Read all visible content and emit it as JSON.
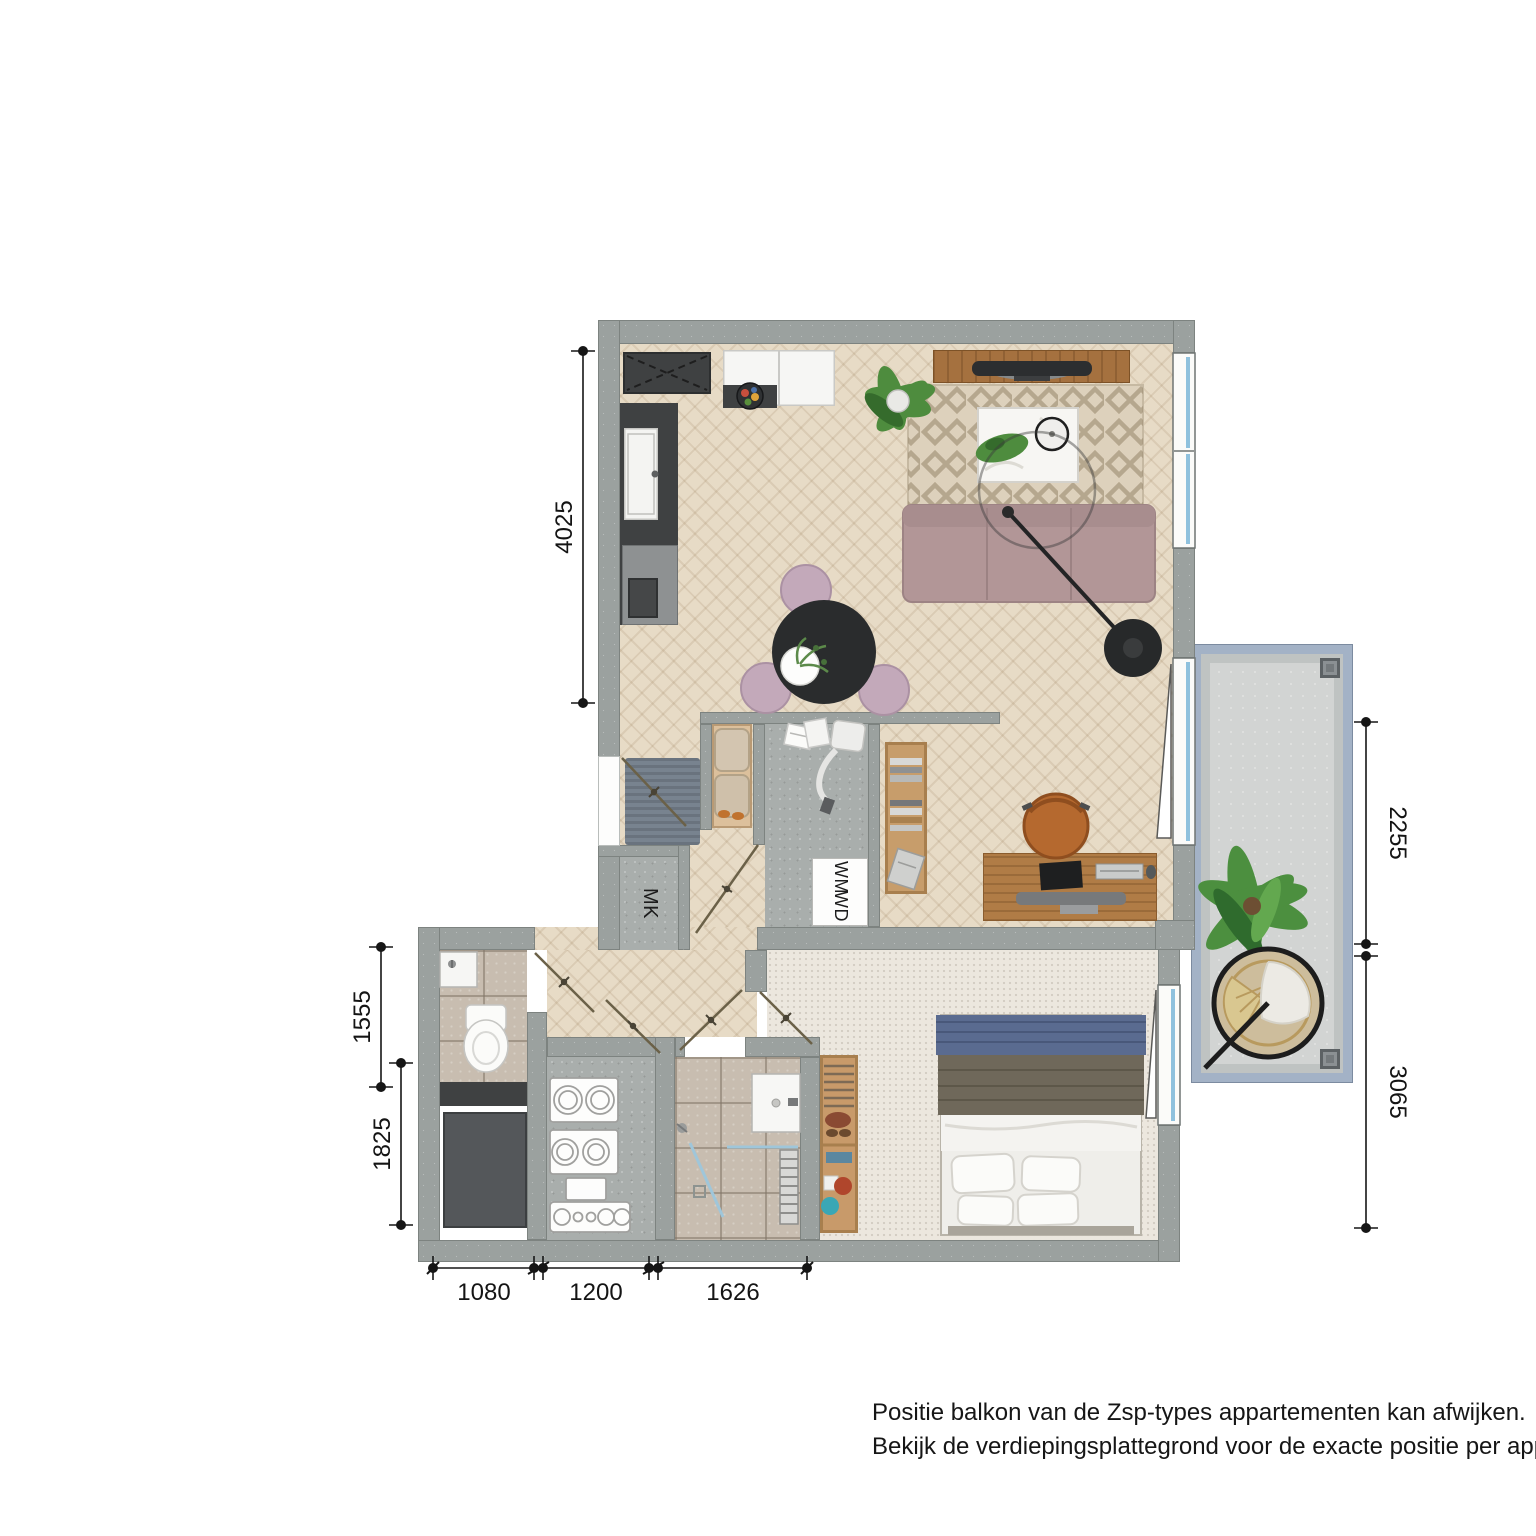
{
  "plan_title": "apartment-floor-plan",
  "labels": {
    "meter_cupboard": "MK",
    "washer": "WM",
    "dryer": "WD"
  },
  "dimensions": {
    "living_left_wall": "4025",
    "toilet_depth_left": "1555",
    "storage_depth_left": "1825",
    "bottom_toilet_width": "1080",
    "bottom_tech_width": "1200",
    "bottom_bathroom_width": "1626",
    "balcony_right_upper": "2255",
    "balcony_right_lower": "3065"
  },
  "footnote": {
    "line1": "Positie balkon van de Zsp-types appartementen kan afwijken.",
    "line2": "Bekijk de verdiepingsplattegrond voor de exacte positie per appartement."
  },
  "colors": {
    "wall": "#9ba19f",
    "wood_floor": "#e7dbc6",
    "carpet": "#ece7de",
    "tile": "#c8bdb0",
    "concrete_floor": "#a9aeac",
    "balcony_rail": "#a3b2c6",
    "balcony_floor": "#d2d4d3",
    "sofa": "#b29697",
    "furniture_wood": "#b07c46",
    "window_glass": "#8fc1dd",
    "dark_fixture": "#3f4142",
    "dining_chair": "#c3a9ba",
    "desk_chair": "#b5692f"
  }
}
